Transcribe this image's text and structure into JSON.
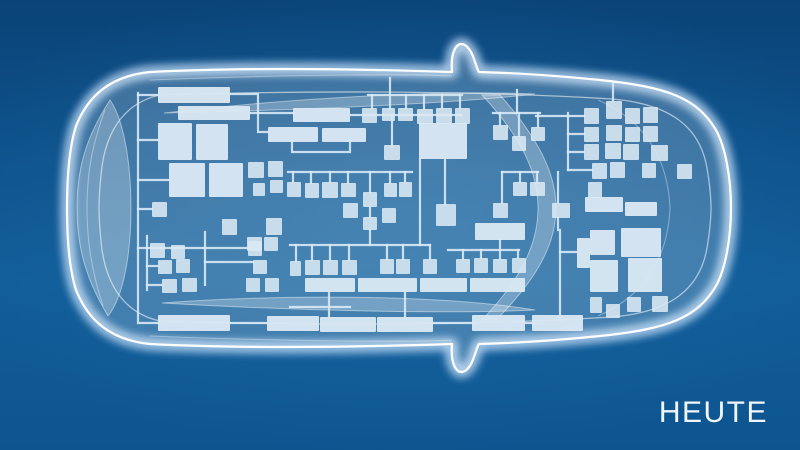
{
  "label": {
    "text": "HEUTE"
  },
  "colors": {
    "background_top": "#0a4377",
    "background_mid": "#115d99",
    "background_bottom": "#0e5590",
    "outline": "#ffffff",
    "glow": "#cfe6ff",
    "body_fill": "rgba(255,255,255,0.20)",
    "contour": "rgba(255,255,255,0.55)",
    "contour_faint": "rgba(255,255,255,0.35)",
    "glass_fill": "rgba(255,255,255,0.26)",
    "box_fill": "#dbe9f4",
    "wire": "#d8e9f6"
  },
  "diagram": {
    "car": {
      "body_path": "M 150,72 C 250,67 360,69 452,72 C 451,62 452,50 458,45 C 465,41 471,50 474,59 C 476,64 477,69 479,72 C 520,73 560,76 600,80 C 668,87 697,98 716,130 C 726,148 731,180 731,208 C 731,236 726,268 716,286 C 697,318 668,329 600,336 C 560,340 520,343 479,344 C 477,347 476,352 474,357 C 471,366 465,375 458,371 C 452,366 451,354 452,344 C 360,347 250,349 150,344 C 110,340 88,320 76,290 C 69,268 67,240 67,208 C 67,176 69,148 76,126 C 88,96 110,76 150,72 Z",
      "inner_outline_path": "M 160,95 C 320,90 480,91 612,99 C 672,104 700,128 707,168 C 710,186 711,196 711,208 C 711,220 710,230 707,248 C 700,288 672,312 612,317 C 480,325 320,326 160,321 C 128,314 108,290 102,250 C 100,232 99,220 99,208 C 99,196 100,184 102,166 C 108,126 128,102 160,95 Z",
      "contours": [
        {
          "name": "rear-hatch-line",
          "d": "M 598,100 C 648,122 668,162 670,208 C 668,254 648,294 598,316"
        },
        {
          "name": "rear-window-crease",
          "d": "M 105,110 C 90,150 87,180 87,208 C 87,236 90,266 103,306"
        },
        {
          "name": "roof-line-top",
          "d": "M 150,80 C 300,74 420,74 452,76"
        },
        {
          "name": "roof-line-bottom",
          "d": "M 150,336 C 300,342 420,342 452,340"
        }
      ],
      "glass": [
        {
          "name": "windshield-band",
          "d": "M 500,95 C 540,140 556,175 556,208 C 556,241 540,276 496,320 L 482,320 C 524,276 538,241 538,208 C 538,175 524,140 482,95 Z"
        },
        {
          "name": "rear-window-band",
          "d": "M 110,100 C 84,140 77,172 77,208 C 77,244 84,276 108,316 C 124,296 131,252 131,208 C 131,164 124,120 110,100 Z"
        },
        {
          "name": "side-glass-top",
          "d": "M 164,113 C 300,97 450,90 535,94 C 450,104 300,110 164,113 Z"
        },
        {
          "name": "side-glass-bottom",
          "d": "M 162,303 C 300,293 450,296 535,310 C 450,314 300,311 162,303 Z"
        }
      ]
    },
    "ecu_boxes": [
      [
        158,
        87,
        72,
        16
      ],
      [
        178,
        106,
        72,
        14
      ],
      [
        158,
        123,
        34,
        37
      ],
      [
        196,
        124,
        32,
        36
      ],
      [
        169,
        163,
        36,
        34
      ],
      [
        209,
        163,
        34,
        34
      ],
      [
        152,
        202,
        15,
        15
      ],
      [
        248,
        162,
        16,
        16
      ],
      [
        268,
        161,
        15,
        16
      ],
      [
        253,
        183,
        12,
        13
      ],
      [
        270,
        180,
        13,
        13
      ],
      [
        222,
        219,
        15,
        16
      ],
      [
        266,
        218,
        16,
        17
      ],
      [
        247,
        237,
        15,
        14
      ],
      [
        264,
        237,
        14,
        14
      ],
      [
        150,
        243,
        15,
        15
      ],
      [
        171,
        245,
        14,
        14
      ],
      [
        158,
        260,
        14,
        14
      ],
      [
        176,
        259,
        14,
        14
      ],
      [
        162,
        279,
        15,
        14
      ],
      [
        182,
        278,
        15,
        14
      ],
      [
        248,
        241,
        14,
        15
      ],
      [
        253,
        260,
        14,
        14
      ],
      [
        246,
        278,
        14,
        14
      ],
      [
        265,
        278,
        14,
        14
      ],
      [
        158,
        315,
        72,
        16
      ],
      [
        293,
        108,
        57,
        14
      ],
      [
        268,
        127,
        50,
        15
      ],
      [
        322,
        128,
        44,
        14
      ],
      [
        362,
        108,
        15,
        15
      ],
      [
        382,
        108,
        13,
        13
      ],
      [
        398,
        108,
        15,
        13
      ],
      [
        417,
        109,
        16,
        15
      ],
      [
        436,
        108,
        16,
        16
      ],
      [
        455,
        108,
        15,
        16
      ],
      [
        419,
        123,
        48,
        36
      ],
      [
        384,
        145,
        16,
        15
      ],
      [
        287,
        182,
        14,
        15
      ],
      [
        305,
        183,
        14,
        15
      ],
      [
        322,
        182,
        16,
        16
      ],
      [
        341,
        183,
        15,
        14
      ],
      [
        363,
        192,
        14,
        15
      ],
      [
        384,
        183,
        13,
        14
      ],
      [
        399,
        182,
        13,
        15
      ],
      [
        343,
        203,
        15,
        15
      ],
      [
        363,
        217,
        14,
        13
      ],
      [
        382,
        208,
        14,
        15
      ],
      [
        436,
        204,
        20,
        22
      ],
      [
        290,
        261,
        11,
        15
      ],
      [
        305,
        260,
        15,
        15
      ],
      [
        323,
        260,
        15,
        15
      ],
      [
        342,
        260,
        15,
        15
      ],
      [
        380,
        259,
        14,
        15
      ],
      [
        396,
        259,
        14,
        15
      ],
      [
        423,
        259,
        14,
        15
      ],
      [
        456,
        259,
        14,
        14
      ],
      [
        474,
        258,
        14,
        15
      ],
      [
        493,
        259,
        14,
        14
      ],
      [
        512,
        258,
        14,
        15
      ],
      [
        305,
        278,
        50,
        14
      ],
      [
        358,
        278,
        59,
        14
      ],
      [
        420,
        278,
        47,
        14
      ],
      [
        470,
        278,
        55,
        14
      ],
      [
        267,
        316,
        52,
        15
      ],
      [
        320,
        317,
        56,
        15
      ],
      [
        377,
        317,
        56,
        15
      ],
      [
        472,
        315,
        53,
        16
      ],
      [
        532,
        315,
        51,
        16
      ],
      [
        493,
        125,
        15,
        15
      ],
      [
        512,
        136,
        14,
        15
      ],
      [
        531,
        127,
        14,
        14
      ],
      [
        513,
        182,
        14,
        14
      ],
      [
        530,
        182,
        15,
        14
      ],
      [
        493,
        203,
        15,
        15
      ],
      [
        552,
        203,
        18,
        15
      ],
      [
        475,
        223,
        50,
        17
      ],
      [
        577,
        238,
        13,
        30
      ],
      [
        584,
        108,
        15,
        16
      ],
      [
        606,
        101,
        16,
        18
      ],
      [
        625,
        108,
        15,
        16
      ],
      [
        643,
        107,
        15,
        16
      ],
      [
        584,
        127,
        15,
        15
      ],
      [
        606,
        125,
        16,
        16
      ],
      [
        625,
        127,
        15,
        15
      ],
      [
        643,
        126,
        15,
        16
      ],
      [
        584,
        144,
        15,
        16
      ],
      [
        605,
        143,
        16,
        16
      ],
      [
        623,
        144,
        16,
        16
      ],
      [
        651,
        145,
        17,
        16
      ],
      [
        592,
        163,
        15,
        16
      ],
      [
        610,
        162,
        15,
        16
      ],
      [
        642,
        163,
        14,
        15
      ],
      [
        677,
        164,
        15,
        15
      ],
      [
        588,
        182,
        14,
        16
      ],
      [
        585,
        197,
        38,
        15
      ],
      [
        625,
        202,
        32,
        14
      ],
      [
        590,
        230,
        25,
        25
      ],
      [
        621,
        228,
        40,
        29
      ],
      [
        590,
        260,
        28,
        32
      ],
      [
        628,
        258,
        34,
        34
      ],
      [
        590,
        297,
        12,
        16
      ],
      [
        606,
        304,
        14,
        14
      ],
      [
        627,
        297,
        14,
        15
      ],
      [
        652,
        296,
        16,
        16
      ]
    ],
    "wires": [
      [
        [
          138,
          93
        ],
        [
          138,
          323
        ],
        [
          158,
          323
        ]
      ],
      [
        [
          138,
          95
        ],
        [
          158,
          95
        ]
      ],
      [
        [
          138,
          140
        ],
        [
          158,
          140
        ]
      ],
      [
        [
          138,
          180
        ],
        [
          169,
          180
        ]
      ],
      [
        [
          138,
          209
        ],
        [
          152,
          209
        ]
      ],
      [
        [
          147,
          236
        ],
        [
          147,
          290
        ]
      ],
      [
        [
          138,
          248
        ],
        [
          205,
          248
        ]
      ],
      [
        [
          147,
          266
        ],
        [
          158,
          266
        ]
      ],
      [
        [
          147,
          285
        ],
        [
          162,
          285
        ]
      ],
      [
        [
          205,
          232
        ],
        [
          205,
          285
        ]
      ],
      [
        [
          205,
          262
        ],
        [
          253,
          262
        ]
      ],
      [
        [
          205,
          248
        ],
        [
          250,
          248
        ]
      ],
      [
        [
          230,
          94
        ],
        [
          258,
          94
        ],
        [
          258,
          132
        ],
        [
          268,
          132
        ]
      ],
      [
        [
          250,
          113
        ],
        [
          293,
          113
        ]
      ],
      [
        [
          350,
          115
        ],
        [
          462,
          115
        ]
      ],
      [
        [
          368,
          95
        ],
        [
          462,
          95
        ]
      ],
      [
        [
          372,
          95
        ],
        [
          372,
          108
        ]
      ],
      [
        [
          390,
          95
        ],
        [
          390,
          109
        ]
      ],
      [
        [
          406,
          95
        ],
        [
          406,
          108
        ]
      ],
      [
        [
          424,
          95
        ],
        [
          424,
          109
        ]
      ],
      [
        [
          442,
          95
        ],
        [
          442,
          108
        ]
      ],
      [
        [
          460,
          95
        ],
        [
          460,
          108
        ]
      ],
      [
        [
          390,
          78
        ],
        [
          390,
          95
        ]
      ],
      [
        [
          392,
          115
        ],
        [
          392,
          146
        ]
      ],
      [
        [
          420,
          159
        ],
        [
          420,
          245
        ]
      ],
      [
        [
          288,
          172
        ],
        [
          412,
          172
        ]
      ],
      [
        [
          293,
          172
        ],
        [
          293,
          182
        ]
      ],
      [
        [
          311,
          172
        ],
        [
          311,
          183
        ]
      ],
      [
        [
          330,
          172
        ],
        [
          330,
          182
        ]
      ],
      [
        [
          348,
          172
        ],
        [
          348,
          183
        ]
      ],
      [
        [
          370,
          172
        ],
        [
          370,
          192
        ]
      ],
      [
        [
          390,
          172
        ],
        [
          390,
          183
        ]
      ],
      [
        [
          405,
          172
        ],
        [
          405,
          182
        ]
      ],
      [
        [
          370,
          207
        ],
        [
          370,
          217
        ]
      ],
      [
        [
          370,
          230
        ],
        [
          370,
          245
        ]
      ],
      [
        [
          290,
          245
        ],
        [
          430,
          245
        ]
      ],
      [
        [
          296,
          245
        ],
        [
          296,
          261
        ]
      ],
      [
        [
          312,
          245
        ],
        [
          312,
          260
        ]
      ],
      [
        [
          330,
          245
        ],
        [
          330,
          260
        ]
      ],
      [
        [
          349,
          245
        ],
        [
          349,
          260
        ]
      ],
      [
        [
          387,
          245
        ],
        [
          387,
          259
        ]
      ],
      [
        [
          403,
          245
        ],
        [
          403,
          259
        ]
      ],
      [
        [
          430,
          245
        ],
        [
          430,
          259
        ]
      ],
      [
        [
          448,
          250
        ],
        [
          519,
          250
        ]
      ],
      [
        [
          463,
          250
        ],
        [
          463,
          259
        ]
      ],
      [
        [
          481,
          250
        ],
        [
          481,
          258
        ]
      ],
      [
        [
          500,
          240
        ],
        [
          500,
          259
        ]
      ],
      [
        [
          518,
          250
        ],
        [
          518,
          258
        ]
      ],
      [
        [
          329,
          292
        ],
        [
          329,
          317
        ]
      ],
      [
        [
          405,
          292
        ],
        [
          405,
          317
        ]
      ],
      [
        [
          290,
          307
        ],
        [
          350,
          307
        ]
      ],
      [
        [
          230,
          323
        ],
        [
          267,
          323
        ]
      ],
      [
        [
          433,
          323
        ],
        [
          472,
          323
        ]
      ],
      [
        [
          525,
          323
        ],
        [
          533,
          323
        ]
      ],
      [
        [
          560,
          230
        ],
        [
          560,
          320
        ]
      ],
      [
        [
          560,
          252
        ],
        [
          577,
          252
        ]
      ],
      [
        [
          536,
          116
        ],
        [
          568,
          116
        ]
      ],
      [
        [
          568,
          113
        ],
        [
          568,
          170
        ]
      ],
      [
        [
          568,
          116
        ],
        [
          584,
          116
        ]
      ],
      [
        [
          568,
          134
        ],
        [
          584,
          134
        ]
      ],
      [
        [
          568,
          152
        ],
        [
          584,
          152
        ]
      ],
      [
        [
          568,
          170
        ],
        [
          592,
          170
        ]
      ],
      [
        [
          493,
          113
        ],
        [
          540,
          113
        ]
      ],
      [
        [
          500,
          113
        ],
        [
          500,
          125
        ]
      ],
      [
        [
          519,
          113
        ],
        [
          519,
          136
        ]
      ],
      [
        [
          538,
          113
        ],
        [
          538,
          127
        ]
      ],
      [
        [
          517,
          90
        ],
        [
          517,
          113
        ]
      ],
      [
        [
          502,
          172
        ],
        [
          538,
          172
        ]
      ],
      [
        [
          520,
          172
        ],
        [
          520,
          182
        ]
      ],
      [
        [
          537,
          172
        ],
        [
          537,
          182
        ]
      ],
      [
        [
          502,
          172
        ],
        [
          502,
          203
        ]
      ],
      [
        [
          558,
          172
        ],
        [
          558,
          203
        ]
      ],
      [
        [
          558,
          218
        ],
        [
          558,
          230
        ]
      ],
      [
        [
          613,
          84
        ],
        [
          613,
          101
        ]
      ],
      [
        [
          445,
          159
        ],
        [
          445,
          204
        ]
      ],
      [
        [
          292,
          142
        ],
        [
          292,
          152
        ],
        [
          350,
          152
        ],
        [
          350,
          143
        ]
      ]
    ]
  }
}
